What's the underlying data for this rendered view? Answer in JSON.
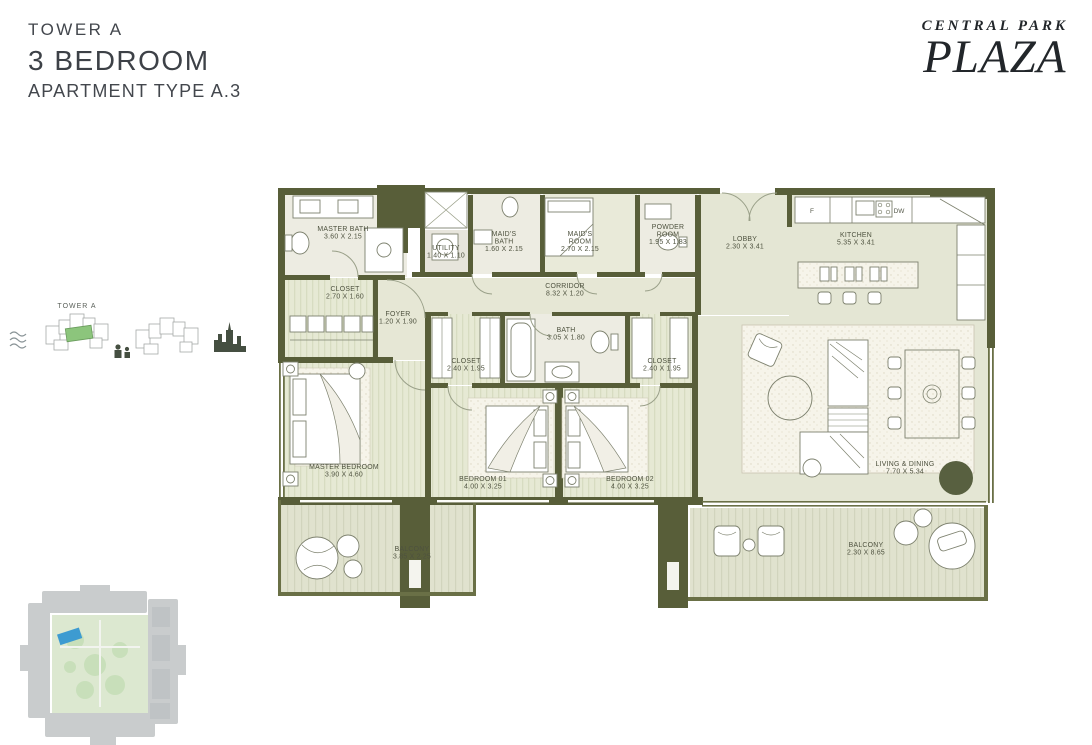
{
  "header": {
    "tower": "TOWER A",
    "bedrooms": "3 BEDROOM",
    "apartment_type": "APARTMENT TYPE A.3"
  },
  "logo": {
    "line1": "CENTRAL PARK",
    "line2": "PLAZA"
  },
  "locator": {
    "tower_label": "TOWER A"
  },
  "floorplan": {
    "appliances": {
      "fridge_label": "F",
      "dishwasher_label": "DW"
    },
    "rooms": [
      {
        "id": "master-bath",
        "lines": [
          "MASTER BATH",
          "3.60 X 2.15"
        ],
        "x": 343,
        "y": 231
      },
      {
        "id": "utility",
        "lines": [
          "UTILITY",
          "1.40 X 1.10"
        ],
        "x": 446,
        "y": 250
      },
      {
        "id": "maids-bath",
        "lines": [
          "MAID'S",
          "BATH",
          "1.60 X 2.15"
        ],
        "x": 504,
        "y": 236
      },
      {
        "id": "maids-room",
        "lines": [
          "MAID'S",
          "ROOM",
          "2.70 X 2.15"
        ],
        "x": 580,
        "y": 236
      },
      {
        "id": "powder-room",
        "lines": [
          "POWDER",
          "ROOM",
          "1.95 X 1.83"
        ],
        "x": 668,
        "y": 229
      },
      {
        "id": "lobby",
        "lines": [
          "LOBBY",
          "2.30 X 3.41"
        ],
        "x": 745,
        "y": 241
      },
      {
        "id": "kitchen",
        "lines": [
          "KITCHEN",
          "5.35 X 3.41"
        ],
        "x": 856,
        "y": 237
      },
      {
        "id": "closet-master",
        "lines": [
          "CLOSET",
          "2.70 X 1.60"
        ],
        "x": 345,
        "y": 291
      },
      {
        "id": "foyer",
        "lines": [
          "FOYER",
          "1.20 X 1.90"
        ],
        "x": 398,
        "y": 316
      },
      {
        "id": "corridor",
        "lines": [
          "CORRIDOR",
          "8.32 X 1.20"
        ],
        "x": 565,
        "y": 288
      },
      {
        "id": "bath",
        "lines": [
          "BATH",
          "3.05 X 1.80"
        ],
        "x": 566,
        "y": 332
      },
      {
        "id": "closet-bedroom01",
        "lines": [
          "CLOSET",
          "2.40 X 1.95"
        ],
        "x": 466,
        "y": 363
      },
      {
        "id": "closet-bedroom02",
        "lines": [
          "CLOSET",
          "2.40 X 1.95"
        ],
        "x": 662,
        "y": 363
      },
      {
        "id": "master-bedroom",
        "lines": [
          "MASTER BEDROOM",
          "3.90 X 4.60"
        ],
        "x": 344,
        "y": 469
      },
      {
        "id": "bedroom-01",
        "lines": [
          "BEDROOM 01",
          "4.00 X 3.25"
        ],
        "x": 483,
        "y": 481
      },
      {
        "id": "bedroom-02",
        "lines": [
          "BEDROOM 02",
          "4.00 X 3.25"
        ],
        "x": 630,
        "y": 481
      },
      {
        "id": "living-dining",
        "lines": [
          "LIVING & DINING",
          "7.70 X 5.34"
        ],
        "x": 905,
        "y": 466
      },
      {
        "id": "balcony-left",
        "lines": [
          "BALCONY",
          "3.85 X 2.25"
        ],
        "x": 412,
        "y": 551
      },
      {
        "id": "balcony-right",
        "lines": [
          "BALCONY",
          "2.30 X 8.65"
        ],
        "x": 866,
        "y": 547
      }
    ]
  },
  "colors": {
    "wall": "#585e39",
    "balcony_wall": "#6a7046",
    "highlight_unit_green": "#8cc57c",
    "site_highlight_blue": "#3d9bd1"
  }
}
